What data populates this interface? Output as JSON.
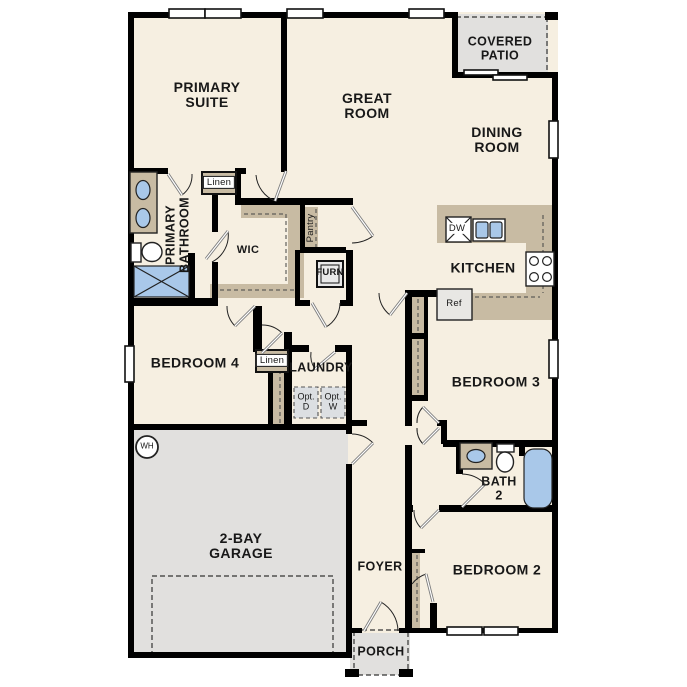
{
  "plan_title": "Single-story house floor plan",
  "rooms": {
    "primary_suite": {
      "line1": "PRIMARY",
      "line2": "SUITE"
    },
    "great_room": {
      "line1": "GREAT",
      "line2": "ROOM"
    },
    "covered_patio": {
      "line1": "COVERED",
      "line2": "PATIO"
    },
    "dining_room": {
      "line1": "DINING",
      "line2": "ROOM"
    },
    "kitchen": {
      "label": "KITCHEN"
    },
    "primary_bathroom": {
      "line1": "PRIMARY",
      "line2": "BATHROOM"
    },
    "wic": {
      "label": "WIC"
    },
    "bedroom4": {
      "label": "BEDROOM 4"
    },
    "laundry": {
      "label": "LAUNDRY"
    },
    "bedroom3": {
      "label": "BEDROOM 3"
    },
    "bath2": {
      "line1": "BATH",
      "line2": "2"
    },
    "bedroom2": {
      "label": "BEDROOM 2"
    },
    "foyer": {
      "label": "FOYER"
    },
    "garage": {
      "line1": "2-BAY",
      "line2": "GARAGE"
    },
    "porch": {
      "label": "PORCH"
    }
  },
  "fixtures": {
    "linen_primary": "Linen",
    "linen_hall": "Linen",
    "pantry": "Pantry",
    "furnace": "FURN",
    "dishwasher": "DW",
    "refrigerator": "Ref",
    "opt_dryer_line1": "Opt.",
    "opt_dryer_line2": "D",
    "opt_washer_line1": "Opt.",
    "opt_washer_line2": "W",
    "water_heater": "WH"
  },
  "colors": {
    "floor": "#f6efe1",
    "wall": "#000000",
    "counter": "#c8bba3",
    "gray_area": "#e1e0de",
    "fixture_blue": "#a9c8e9",
    "appliance": "#e8e7e4",
    "opt_box": "#dcdfe2",
    "door": "#7d7d7d"
  }
}
